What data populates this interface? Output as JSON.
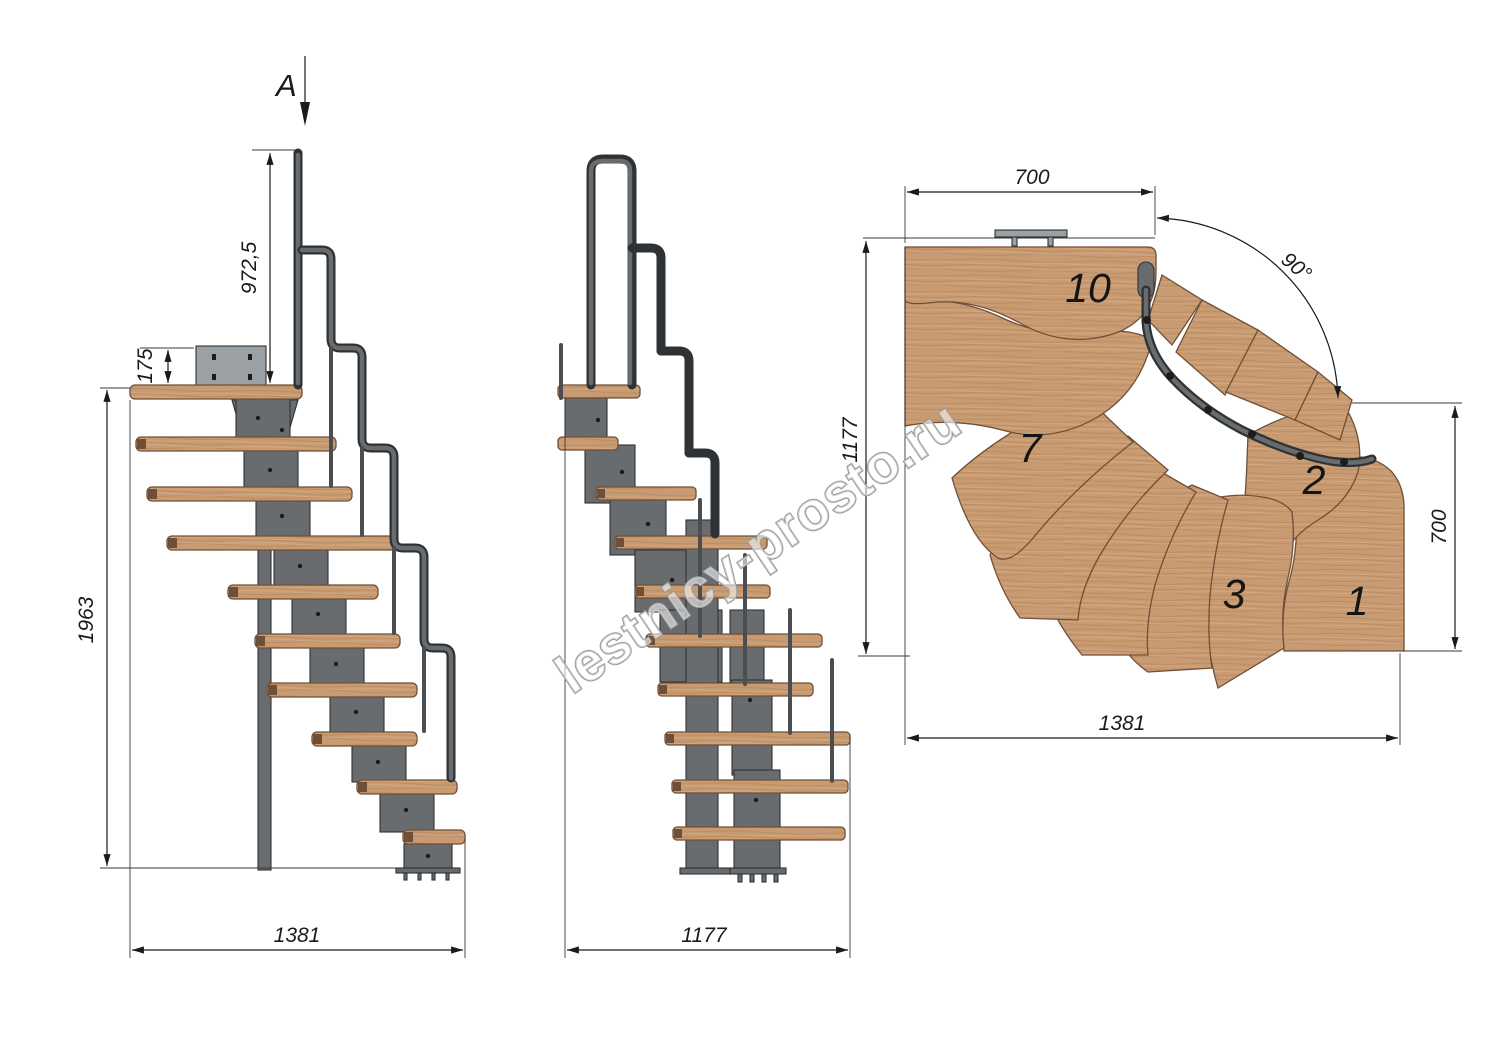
{
  "drawing": {
    "section_label": "A",
    "watermark": "lestnicy-prosto.ru",
    "side_view": {
      "handrail_height": "972,5",
      "plate_offset": "175",
      "total_height": "1963",
      "total_length": "1381"
    },
    "front_view": {
      "total_width": "1177"
    },
    "plan_view": {
      "top_width": "700",
      "turn_angle": "90°",
      "left_depth": "1177",
      "right_depth": "700",
      "total_length": "1381",
      "treads": {
        "t10": "10",
        "t7": "7",
        "t2": "2",
        "t3": "3",
        "t1": "1"
      }
    },
    "colors": {
      "wood": "#c99b72",
      "woodDark": "#ab7f57",
      "woodLight": "#dcb58d",
      "woodEdge": "#6f4f38",
      "metal": "#686c6f",
      "metalDark": "#2f3234",
      "metalLight": "#9aa0a4",
      "line": "#1a1a1a",
      "watermark": "#9a9a9a"
    }
  }
}
